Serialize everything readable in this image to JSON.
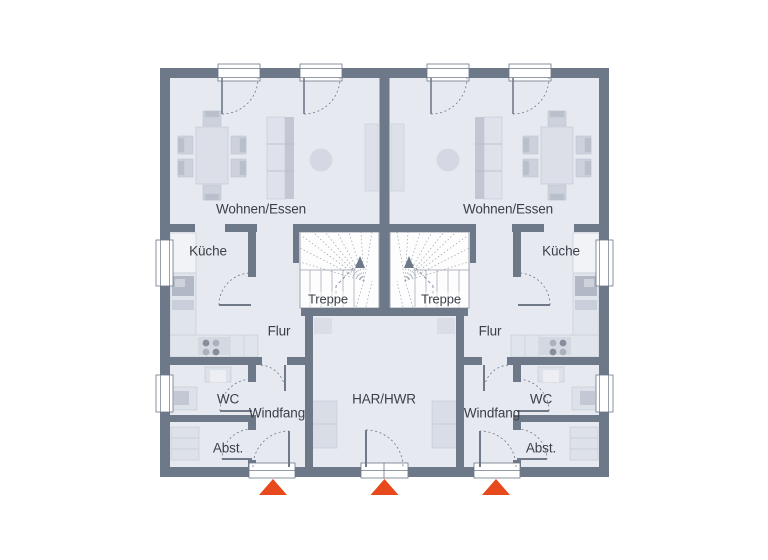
{
  "plan": {
    "labels": {
      "living_left": "Wohnen/Essen",
      "living_right": "Wohnen/Essen",
      "kitchen_left": "Küche",
      "kitchen_right": "Küche",
      "stairs_left": "Treppe",
      "stairs_right": "Treppe",
      "hall_left": "Flur",
      "hall_right": "Flur",
      "wc_left": "WC",
      "wc_right": "WC",
      "vestibule_left": "Windfang",
      "vestibule_right": "Windfang",
      "storage_left": "Abst.",
      "storage_right": "Abst.",
      "utility_center": "HAR/HWR"
    },
    "markers": {
      "entrance_icon": "entrance-triangle-icon",
      "entrance_count": 3
    },
    "colors": {
      "wall": "#6d7888",
      "floor": "#e6e9f0",
      "accent": "#e8491c",
      "text": "#3b4047",
      "furniture": "#dcdfe8",
      "furniture_dark": "#b9bfcb"
    }
  }
}
